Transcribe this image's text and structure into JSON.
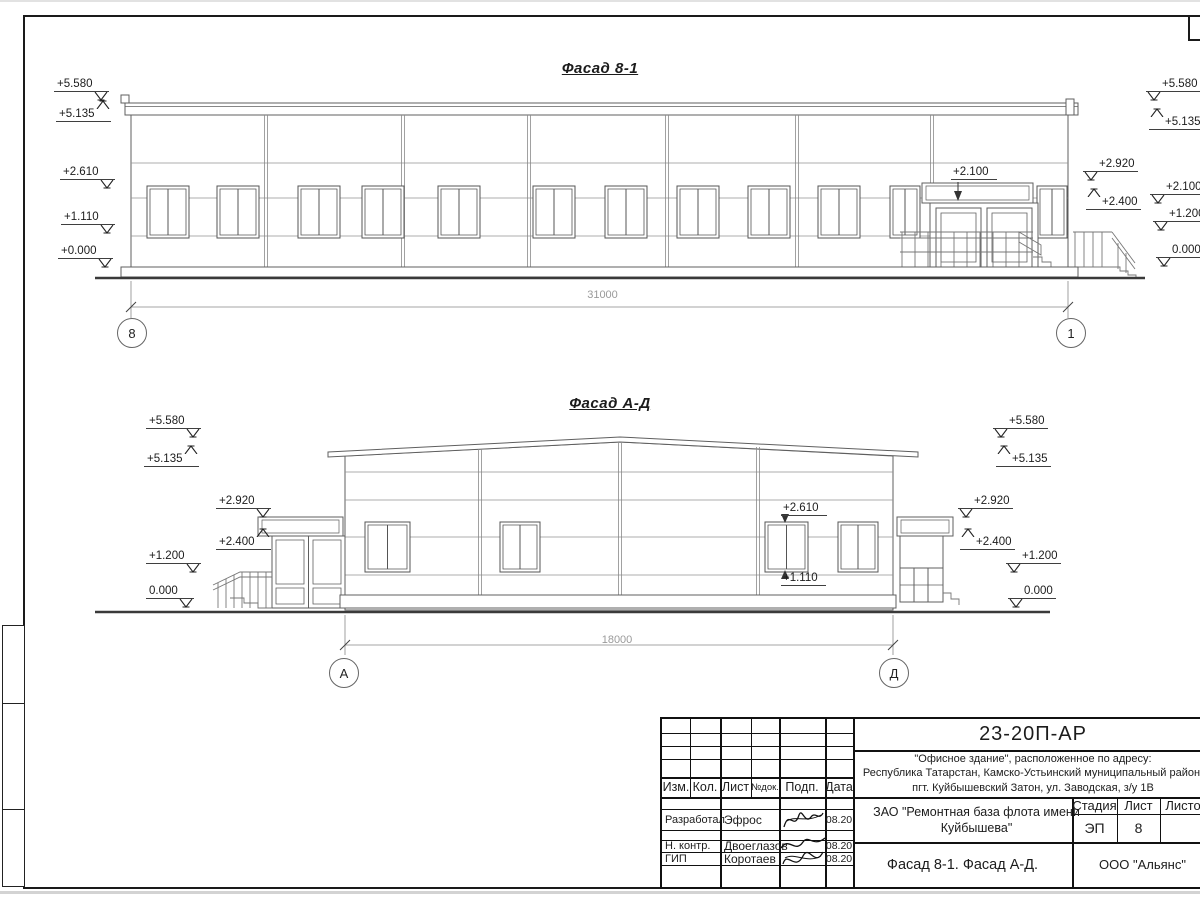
{
  "doc": {
    "f1": {
      "title": "Фасад 8-1",
      "dimension": "31000",
      "axis_left": "8",
      "axis_right": "1",
      "note": "+2.100",
      "left_marks": [
        "+5.580",
        "+5.135",
        "+2.610",
        "+1.110",
        "+0.000"
      ],
      "right_inner": [
        "+2.920",
        "+2.400"
      ],
      "right_outer": [
        "+5.580",
        "+5.135",
        "+2.100",
        "+1.200",
        "0.000"
      ]
    },
    "f2": {
      "title": "Фасад А-Д",
      "dimension": "18000",
      "axis_left": "А",
      "axis_right": "Д",
      "notes": [
        "+2.610",
        "+1.110"
      ],
      "left_outer": [
        "+5.580",
        "+5.135",
        "+1.200",
        "0.000"
      ],
      "left_inner": [
        "+2.920",
        "+2.400"
      ],
      "right_inner": [
        "+2.920",
        "+2.400"
      ],
      "right_outer": [
        "+5.580",
        "+5.135",
        "+1.200",
        "0.000"
      ]
    },
    "title_block": {
      "doc_number": "23-20П-АР",
      "address_line1": "\"Офисное здание\", расположенное по адресу:",
      "address_line2": "Республика Татарстан, Камско-Устьинский муниципальный район,",
      "address_line3": "пгт. Куйбышевский Затон, ул. Заводская, з/у 1В",
      "client": "ЗАО \"Ремонтная база флота имени Куйбышева\"",
      "sheet_title": "Фасад 8-1. Фасад А-Д.",
      "company": "ООО \"Альянс\"",
      "col_izm": "Изм.",
      "col_kol": "Кол.",
      "col_list": "Лист",
      "col_ndok": "№док.",
      "col_podp": "Подп.",
      "col_data": "Дата",
      "stage_label": "Стадия",
      "sheet_label": "Лист",
      "sheets_label": "Листов",
      "stage_value": "ЭП",
      "sheet_value": "8",
      "rows": [
        {
          "role": "Разработал",
          "name": "Эфрос",
          "date": "08.20"
        },
        {
          "role": "Н. контр.",
          "name": "Двоеглазов",
          "date": "08.20"
        },
        {
          "role": "ГИП",
          "name": "Коротаев",
          "date": "08.20"
        }
      ]
    }
  }
}
